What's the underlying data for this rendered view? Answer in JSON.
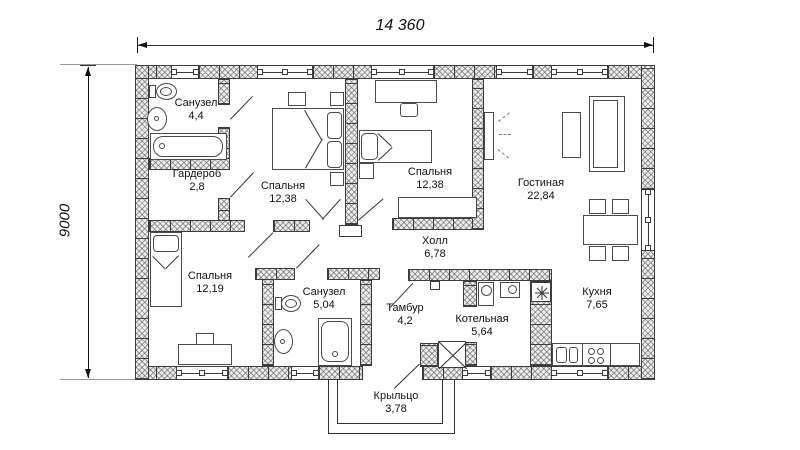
{
  "plan": {
    "dim_width": "14 360",
    "dim_height": "9000"
  },
  "rooms": [
    {
      "id": "sanuzel-1",
      "name": "Санузел",
      "area": "4,4"
    },
    {
      "id": "garderob",
      "name": "Гардероб",
      "area": "2,8"
    },
    {
      "id": "spalnya-1",
      "name": "Спальня",
      "area": "12,38"
    },
    {
      "id": "spalnya-2",
      "name": "Спальня",
      "area": "12,38"
    },
    {
      "id": "gostinaya",
      "name": "Гостиная",
      "area": "22,84"
    },
    {
      "id": "spalnya-3",
      "name": "Спальня",
      "area": "12,19"
    },
    {
      "id": "sanuzel-2",
      "name": "Санузел",
      "area": "5,04"
    },
    {
      "id": "holl",
      "name": "Холл",
      "area": "6,78"
    },
    {
      "id": "tambur",
      "name": "Тамбур",
      "area": "4,2"
    },
    {
      "id": "kotelnaya",
      "name": "Котельная",
      "area": "5,64"
    },
    {
      "id": "kuhnya",
      "name": "Кухня",
      "area": "7,65"
    },
    {
      "id": "krylco",
      "name": "Крыльцо",
      "area": "3,78"
    }
  ]
}
